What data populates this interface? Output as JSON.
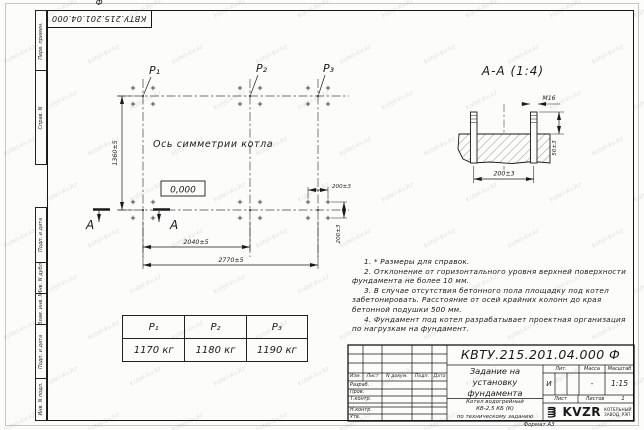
{
  "stamp": {
    "doc_number": "КВТУ.215.201.04.000 Ф"
  },
  "margin": {
    "top": [
      "Перв. примен.",
      "Справ. N"
    ],
    "bottom": [
      "Подп. и дата",
      "Инв. N дубл.",
      "Взам. инв. N",
      "Подп. и дата",
      "Инв. N подл."
    ]
  },
  "plan": {
    "column_labels": [
      "P₁",
      "P₂",
      "P₃"
    ],
    "axis_label": "Ось симметрии котла",
    "elevation": "0,000",
    "dim_height": "1360±5",
    "dim_width_inner": "2040±5",
    "dim_width_outer": "2770±5",
    "dim_bolt_h": "200±3",
    "dim_bolt_v": "200±3",
    "section_letter_left": "А",
    "section_letter_right": "А"
  },
  "section": {
    "title": "А-А (1:4)",
    "thread_label": "М16",
    "dim_spacing": "200±3",
    "dim_height": "50±3"
  },
  "notes": {
    "items": [
      "1. * Размеры для справок.",
      "2. Отклонение от горизонтального уровня верхней поверхности фундамента не более 10 мм.",
      "3. В случае отсутствия бетонного пола площадку под котел забетонировать. Расстояние от осей крайних колонн до края бетонной подушки 500 мм.",
      "4. Фундамент под котел разрабатывает проектная организация по нагрузкам на фундамент."
    ]
  },
  "load_table": {
    "headers": [
      "P₁",
      "P₂",
      "P₃"
    ],
    "values": [
      "1170 кг",
      "1180 кг",
      "1190 кг"
    ]
  },
  "title_block": {
    "doc_number": "КВТУ.215.201.04.000 Ф",
    "title_lines": [
      "Задание на",
      "установку",
      "фундамента"
    ],
    "product_lines": [
      "Котел водогрейный",
      "КВ-2,5 КБ (К)",
      "по техническому заданию"
    ],
    "headers": {
      "izm": "Изм.",
      "sheet_col": "Лист",
      "doc": "N докум.",
      "sign": "Подп.",
      "date": "Дата"
    },
    "row_labels": [
      "Разраб.",
      "Пров.",
      "Т.контр.",
      "Н.контр.",
      "Утв."
    ],
    "lit_label": "Лит.",
    "mass_label": "Масса",
    "scale_label": "Масштаб",
    "lit_value": "И",
    "mass_value": "-",
    "scale_value": "1:15",
    "sheet_label": "Лист",
    "sheets_label": "Листов",
    "sheets_value": "1",
    "logo_text": "KVZR",
    "logo_caption_lines": [
      "КОТЕЛЬНЫЙ",
      "ЗАВОД, РЭП"
    ],
    "format_label": "Формат А3"
  },
  "watermark": {
    "text": "kotel-kv.kz"
  }
}
